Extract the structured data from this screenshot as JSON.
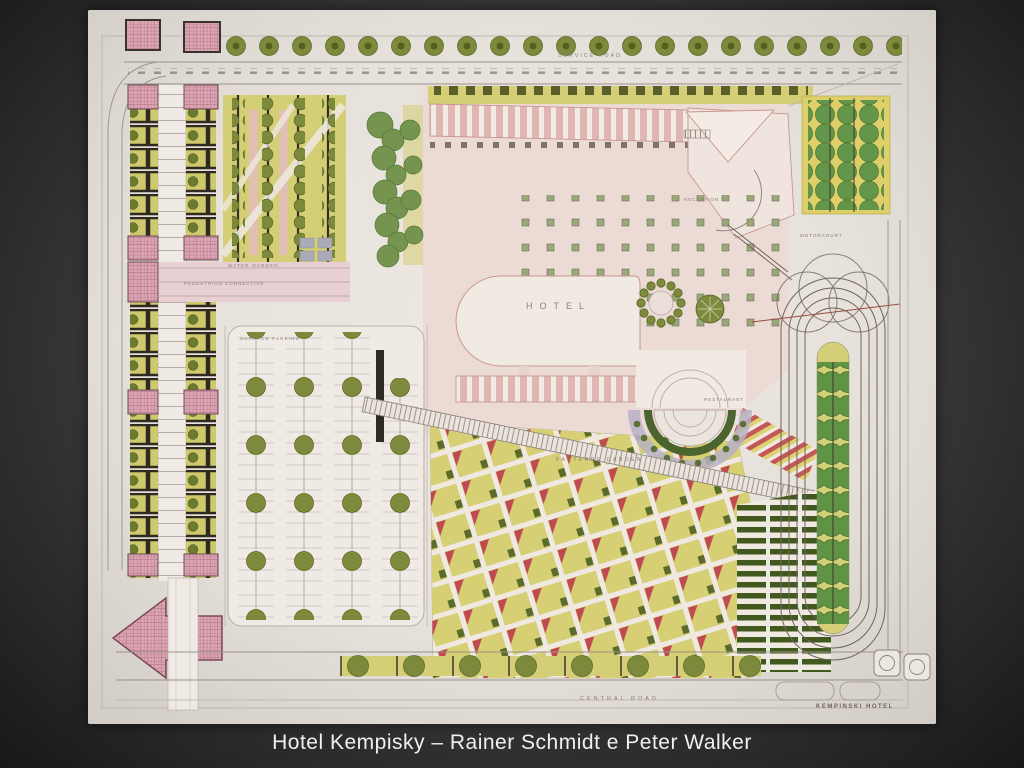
{
  "slide": {
    "caption": "Hotel Kempisky – Rainer Schmidt e Peter Walker"
  },
  "plan": {
    "labels": {
      "service_road": "SERVICE ROAD",
      "water_garden": "WATER GARDEN",
      "pedestrian_connective": "PEDESTRIAN CONNECTIVE",
      "surface_parking": "SURFACE PARKING",
      "hotel": "HOTEL",
      "reception": "RECEPTION",
      "motorcourt": "MOTORCOURT",
      "restaurant": "RESTAURANT",
      "parterre_garden": "PARTERRE GARDEN",
      "central_road": "CENTRAL ROAD",
      "kempinski_hotel": "KEMPINSKI HOTEL"
    },
    "colors": {
      "slide_bg": "#3b3b3b",
      "caption_color": "#f0f0f0",
      "paper": "#e7e2dc",
      "lawn_yellow": "#d4cf76",
      "tree_olive": "#7d8a3c",
      "tree_green": "#63964a",
      "accent_red": "#c04a52",
      "pink": "#dca4b2",
      "hedge_green": "#41581f",
      "label_ink": "#8a7d70"
    }
  }
}
